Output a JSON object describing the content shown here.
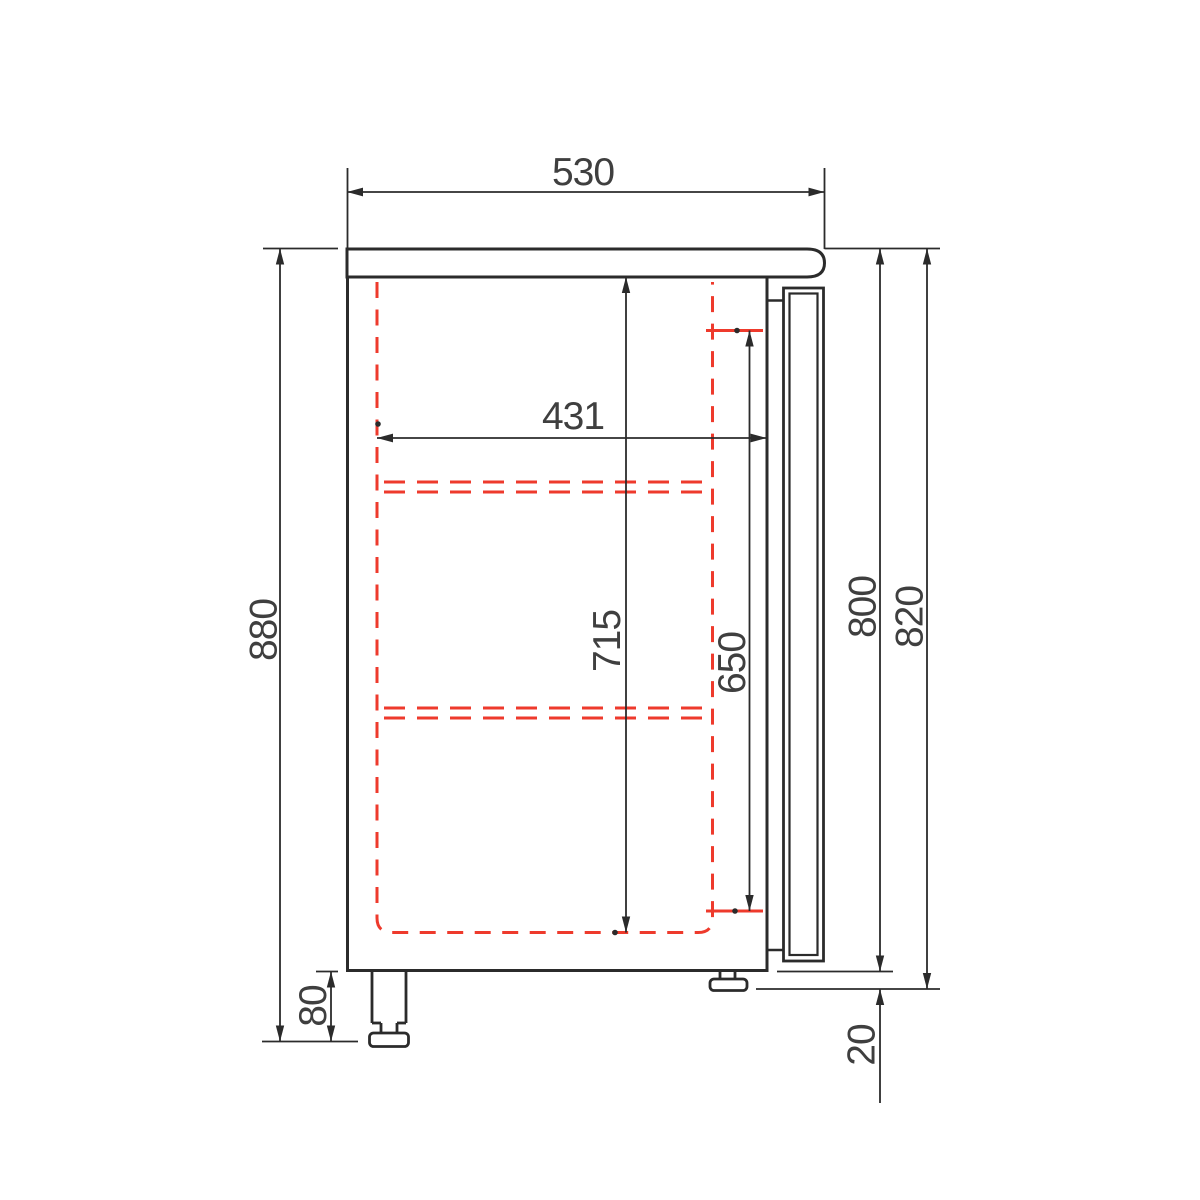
{
  "dimensions": {
    "top_width": "530",
    "inner_depth": "431",
    "inner_height": "715",
    "opening_height": "650",
    "overall_height": "880",
    "body_height": "800",
    "body_plus_door_height": "820",
    "leg_height": "80",
    "door_drop": "20"
  },
  "colors": {
    "line": "#2b2b2b",
    "hidden_line_red": "#ee3a2c",
    "dim_text": "#3f3f3f",
    "background": "#ffffff"
  }
}
